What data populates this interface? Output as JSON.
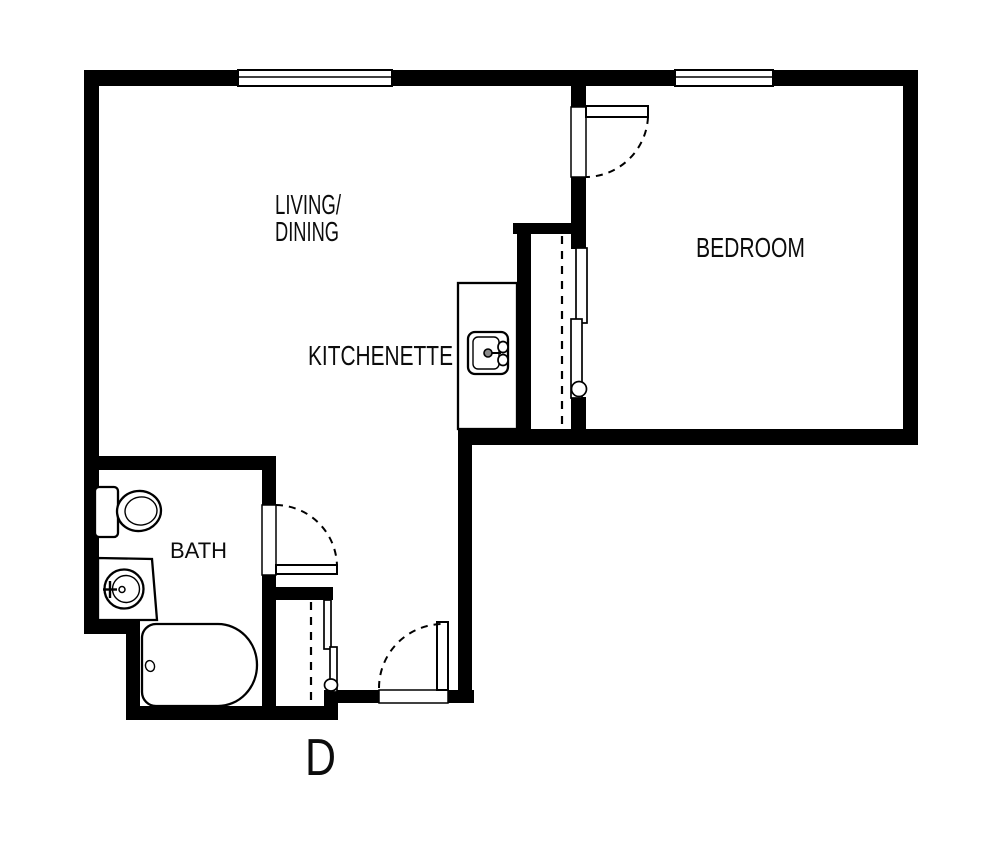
{
  "plan": {
    "unit_label": "D",
    "rooms": {
      "living_dining": {
        "line1": "LIVING/",
        "line2": "DINING"
      },
      "kitchenette": {
        "label": "KITCHENETTE"
      },
      "bedroom": {
        "label": "BEDROOM"
      },
      "bath": {
        "label": "BATH"
      }
    },
    "features": {
      "windows": [
        "living-window",
        "bedroom-window"
      ],
      "doors": [
        "bedroom-door",
        "bath-door",
        "entry-door"
      ],
      "closets": [
        "bedroom-closet",
        "hall-closet"
      ],
      "fixtures": [
        "toilet",
        "bathroom-sink",
        "bathtub",
        "kitchen-sink",
        "kitchenette-counter"
      ]
    },
    "colors": {
      "wall": "#000000",
      "background": "#ffffff",
      "line": "#000000"
    }
  }
}
